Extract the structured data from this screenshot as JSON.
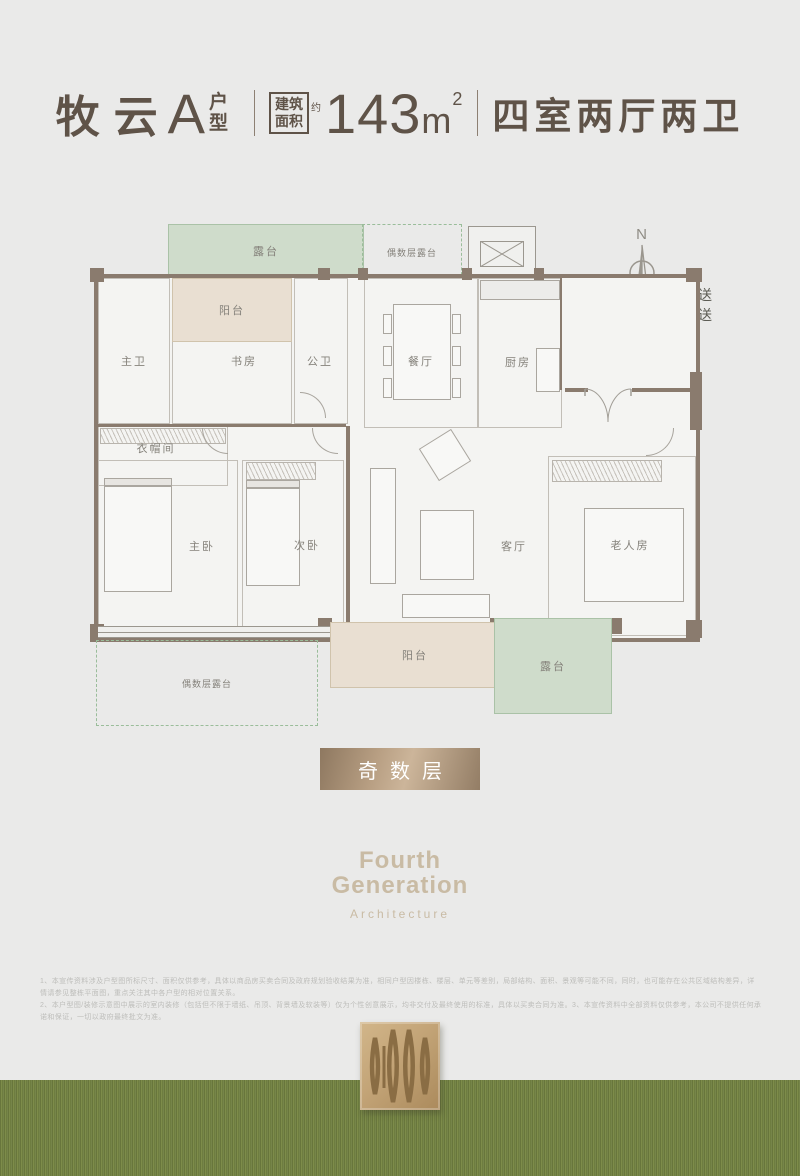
{
  "header": {
    "name": "牧云",
    "type_letter": "A",
    "type_suffix_top": "户",
    "type_suffix_bottom": "型",
    "area_label_line1": "建筑",
    "area_label_line2": "面积",
    "area_approx": "约",
    "area_number": "143",
    "area_unit": "m",
    "area_sup": "2",
    "rooms_summary": "四室两厅两卫"
  },
  "compass": {
    "label": "N"
  },
  "legend": {
    "items": [
      {
        "label": "全赠送",
        "color": "#cfdccb"
      },
      {
        "label": "半赠送",
        "color": "#e9dfd2"
      }
    ]
  },
  "floorplan": {
    "colors": {
      "wall": "#8a7b6e",
      "gift_full": "#cfdccb",
      "gift_half": "#e9dfd2"
    },
    "rooms": [
      {
        "id": "terrace-top",
        "label": "露台"
      },
      {
        "id": "even-terrace-top",
        "label": "偶数层露台"
      },
      {
        "id": "balcony-top",
        "label": "阳台"
      },
      {
        "id": "master-bath",
        "label": "主卫"
      },
      {
        "id": "study",
        "label": "书房"
      },
      {
        "id": "public-bath",
        "label": "公卫"
      },
      {
        "id": "dining",
        "label": "餐厅"
      },
      {
        "id": "kitchen",
        "label": "厨房"
      },
      {
        "id": "cloakroom",
        "label": "衣帽间"
      },
      {
        "id": "master-bedroom",
        "label": "主卧"
      },
      {
        "id": "second-bedroom",
        "label": "次卧"
      },
      {
        "id": "living-room",
        "label": "客厅"
      },
      {
        "id": "elder-room",
        "label": "老人房"
      },
      {
        "id": "balcony-bottom",
        "label": "阳台"
      },
      {
        "id": "terrace-bottom",
        "label": "露台"
      },
      {
        "id": "even-terrace-bottom",
        "label": "偶数层露台"
      }
    ]
  },
  "floor_badge": {
    "label": "奇数层"
  },
  "branding": {
    "line1": "Fourth",
    "line2": "Generation",
    "line3": "Architecture",
    "color": "#c9bba4"
  },
  "disclaimer": {
    "line1": "1、本宣传资料涉及户型图所标尺寸、面积仅供参考，具体以商品房买卖合同及政府规划验收结果为准，相同户型因楼栋、楼层、单元等差别，局部结构、面积、景观等可能不同，同时，也可能存在公共区域结构差异，详情请参见整栋平面图，重点关注其中各户型的相对位置关系。",
    "line2": "2、本户型图/装修示意图中展示的室内装修（包括但不限于墙纸、吊顶、背景墙及软装等）仅为个性创意展示，均非交付及最终使用的标准，具体以买卖合同为准。3、本宣传资料中全部资料仅供参考，本公司不提供任何承诺和保证，一切以政府最终批文为准。"
  },
  "footer": {
    "grass_color": "#6e7d40",
    "logo_name": "brand-logo"
  }
}
